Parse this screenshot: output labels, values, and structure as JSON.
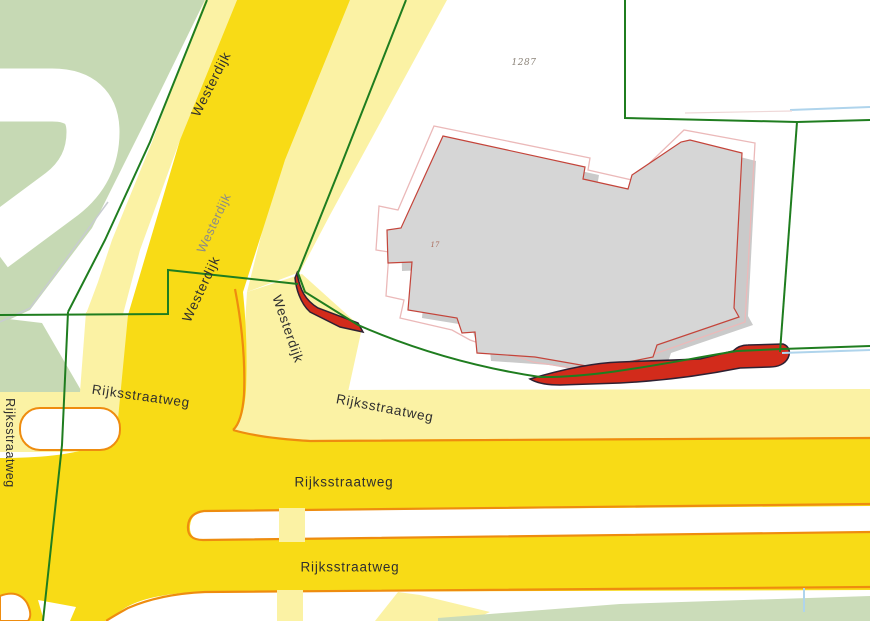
{
  "map": {
    "labels": {
      "westerdijk": "Westerdijk",
      "rijksstraatweg": "Rijksstraatweg",
      "parcel_number": "1287",
      "house_number": "17"
    },
    "colors": {
      "road_major": "#F8DB16",
      "road_minor": "#FBF2A4",
      "road_casing": "#EE8C0F",
      "greenery": "#C6D9B4",
      "greenery_strip": "#CBDCB9",
      "building_fill": "#D6D6D6",
      "building_shadow": "#CACACA",
      "building_outline": "#C4443A",
      "parcel_outline_faint": "#EBB9B9",
      "parcel_boundary": "#1F7D1F",
      "highlight_fill": "#D22B1B",
      "highlight_outline": "#2E2133",
      "water_line": "#AFD4EC",
      "label_dark": "#2F2F2F",
      "label_gray": "#8A8A8A"
    }
  }
}
